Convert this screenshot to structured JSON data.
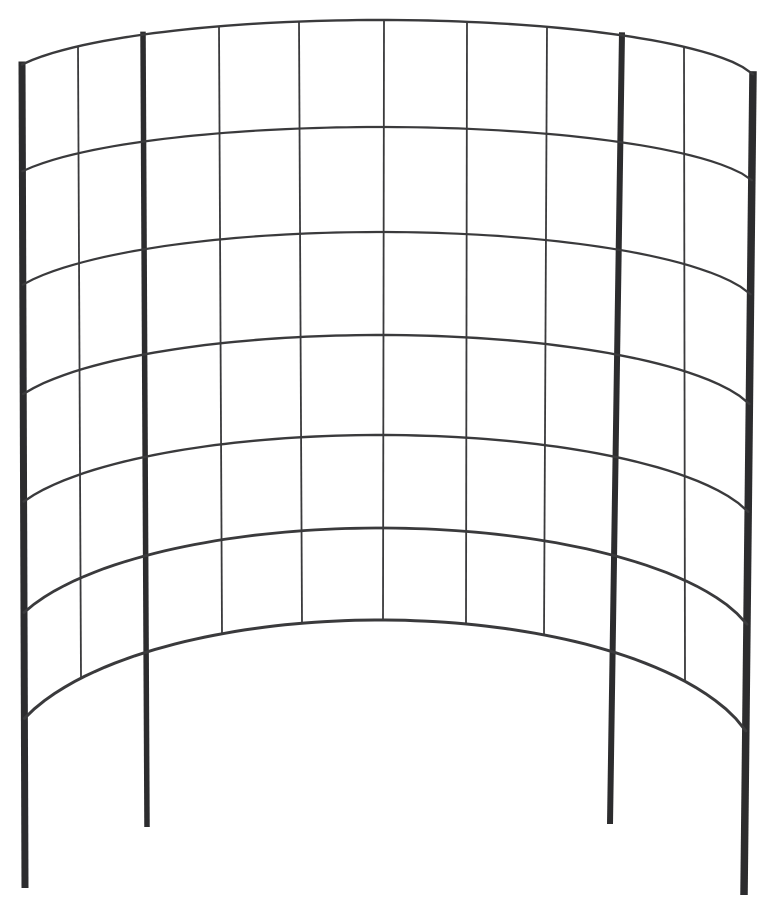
{
  "image": {
    "description": "black curved wire garden trellis panel with ground stakes on a plain white background",
    "background_color": "#ffffff",
    "wire_color": "#3a3a3c",
    "post_color": "#2c2c2e",
    "canvas": {
      "width": 768,
      "height": 922
    }
  },
  "trellis": {
    "grid_columns": 10,
    "grid_rows": 6,
    "arc": {
      "center_x": 380,
      "radius": 380
    },
    "horizontal_wires": [
      {
        "y_center": 20,
        "amplitude": 67,
        "width": 2.4
      },
      {
        "y_center": 127,
        "amplitude": 67,
        "width": 2.2
      },
      {
        "y_center": 232,
        "amplitude": 80,
        "width": 2.2
      },
      {
        "y_center": 335,
        "amplitude": 90,
        "width": 2.4
      },
      {
        "y_center": 435,
        "amplitude": 102,
        "width": 2.4
      },
      {
        "y_center": 528,
        "amplitude": 130,
        "width": 2.8
      },
      {
        "y_center": 620,
        "amplitude": 152,
        "width": 3.0
      }
    ],
    "vertical_wires": [
      {
        "type": "post",
        "x_top": 22,
        "x_bottom": 25,
        "leg_bottom": 888,
        "width": 7.0
      },
      {
        "type": "wire",
        "x_top": 78,
        "x_bottom": 81,
        "width": 1.8
      },
      {
        "type": "post",
        "x_top": 143,
        "x_bottom": 147,
        "leg_bottom": 827,
        "width": 5.5
      },
      {
        "type": "wire",
        "x_top": 219,
        "x_bottom": 222,
        "width": 1.8
      },
      {
        "type": "wire",
        "x_top": 299,
        "x_bottom": 302,
        "width": 1.8
      },
      {
        "type": "wire",
        "x_top": 384,
        "x_bottom": 383,
        "width": 1.8
      },
      {
        "type": "wire",
        "x_top": 467,
        "x_bottom": 466,
        "width": 1.8
      },
      {
        "type": "wire",
        "x_top": 547,
        "x_bottom": 544,
        "width": 1.8
      },
      {
        "type": "post",
        "x_top": 622,
        "x_bottom": 610,
        "leg_bottom": 824,
        "width": 6.0
      },
      {
        "type": "wire",
        "x_top": 684,
        "x_bottom": 685,
        "width": 1.8
      },
      {
        "type": "post",
        "x_top": 753,
        "x_bottom": 744,
        "leg_bottom": 895,
        "width": 7.5
      }
    ]
  }
}
